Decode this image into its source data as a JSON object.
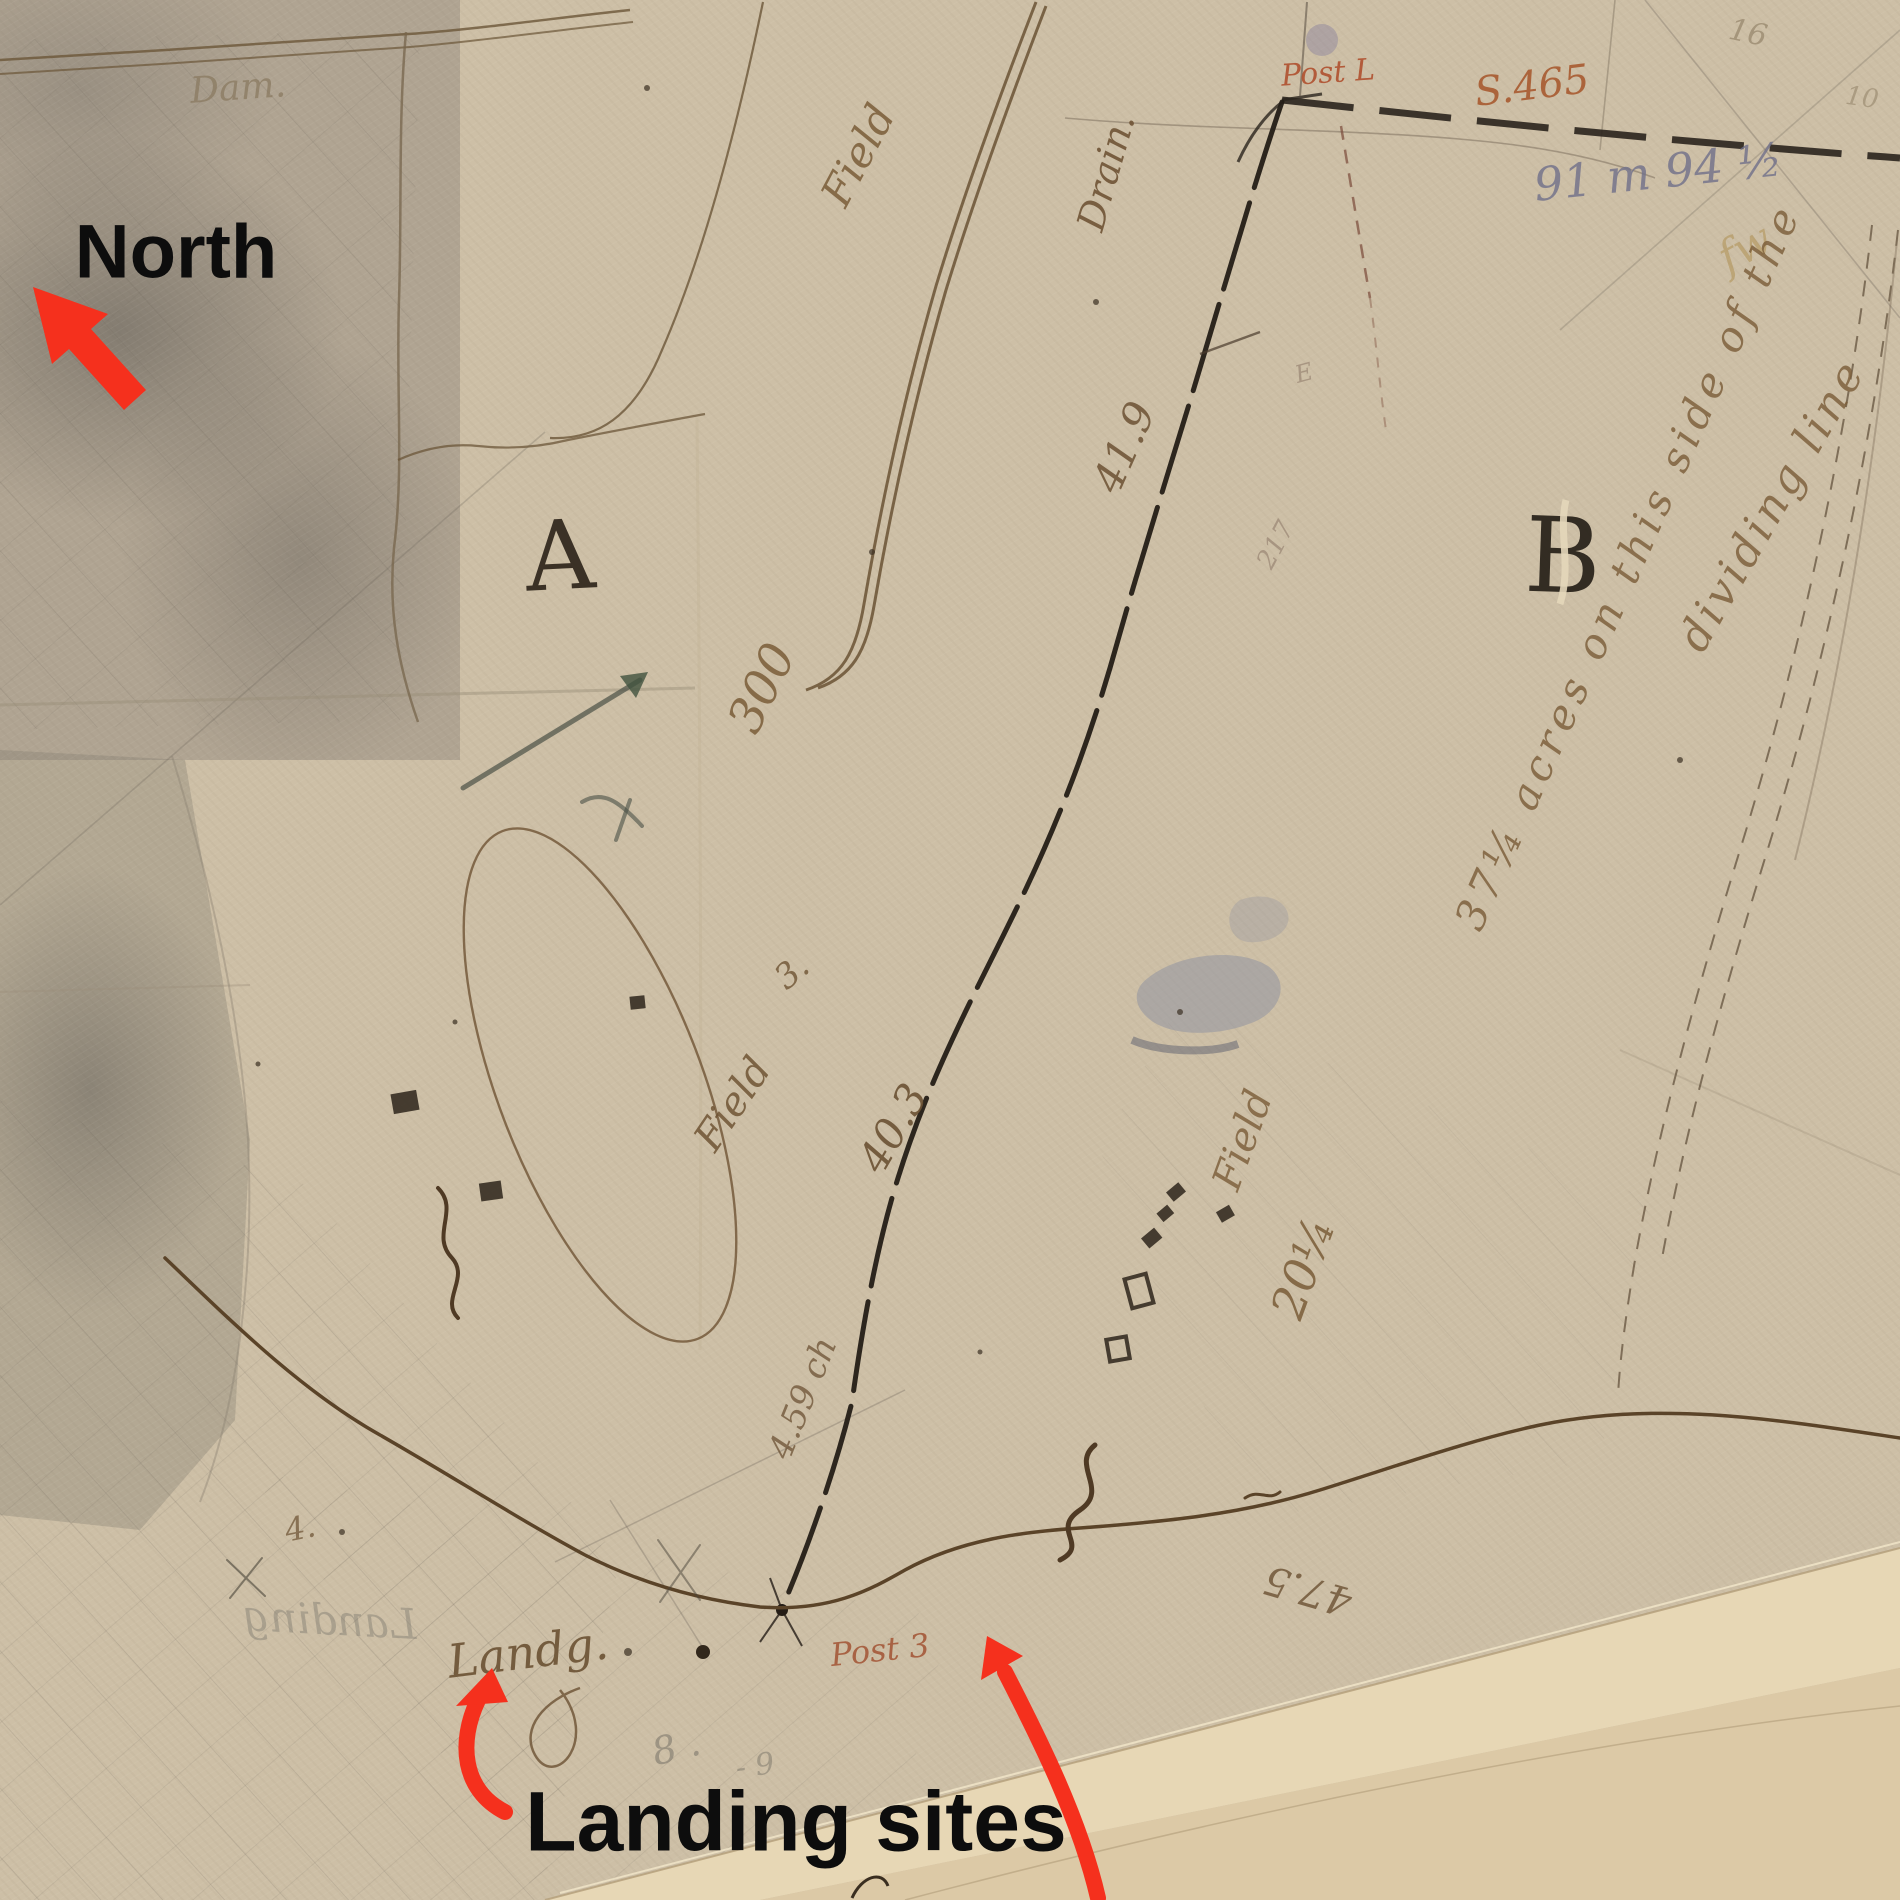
{
  "title": "Annotated historical survey map",
  "palette": {
    "paper": "#cdbfa6",
    "ink_brown": "#6b5335",
    "ink_dark": "#241d16",
    "ink_red": "#a85a30",
    "pencil_blue": "#70708a",
    "pencil_grey": "#6f6a60",
    "overlay_red": "#f5301d",
    "overlay_black": "#0d0d0d"
  },
  "annotations": {
    "north_label": "North",
    "landing_sites_label": "Landing sites",
    "arrows": [
      {
        "name": "north-arrow",
        "points": "up-left"
      },
      {
        "name": "landing-arrow-left",
        "points": "up"
      },
      {
        "name": "landing-arrow-right",
        "points": "up-left"
      }
    ]
  },
  "map": {
    "regions": {
      "letter_a": "A",
      "letter_b": "B"
    },
    "labels": {
      "dam": "Dam.",
      "field_top": "Field",
      "drain": "Drain.",
      "post_l": "Post L",
      "s465": "S.465",
      "survey_blue": "91 m 94 ½",
      "corner_16": "16",
      "corner_10": "10",
      "scribble_fw": "fw",
      "num_300": "300",
      "field3": "Field",
      "field3_num": "3.",
      "num_41_9": "41.9",
      "num_40_3": "40.3",
      "num_4_59": "4.59 ch",
      "field20": "Field",
      "field20_num": "20¼",
      "acres_line1": "37¼ acres on this side of the",
      "acres_line2": "dividing line",
      "landing_script": "Landg.",
      "landing_mirror": "Landing",
      "post3": "Post 3",
      "num_47_5": "47.5",
      "num_217": "217",
      "mark_e": "E",
      "small_4": "4.",
      "pencil_8": "8 .",
      "pencil_9": "- 9"
    }
  }
}
